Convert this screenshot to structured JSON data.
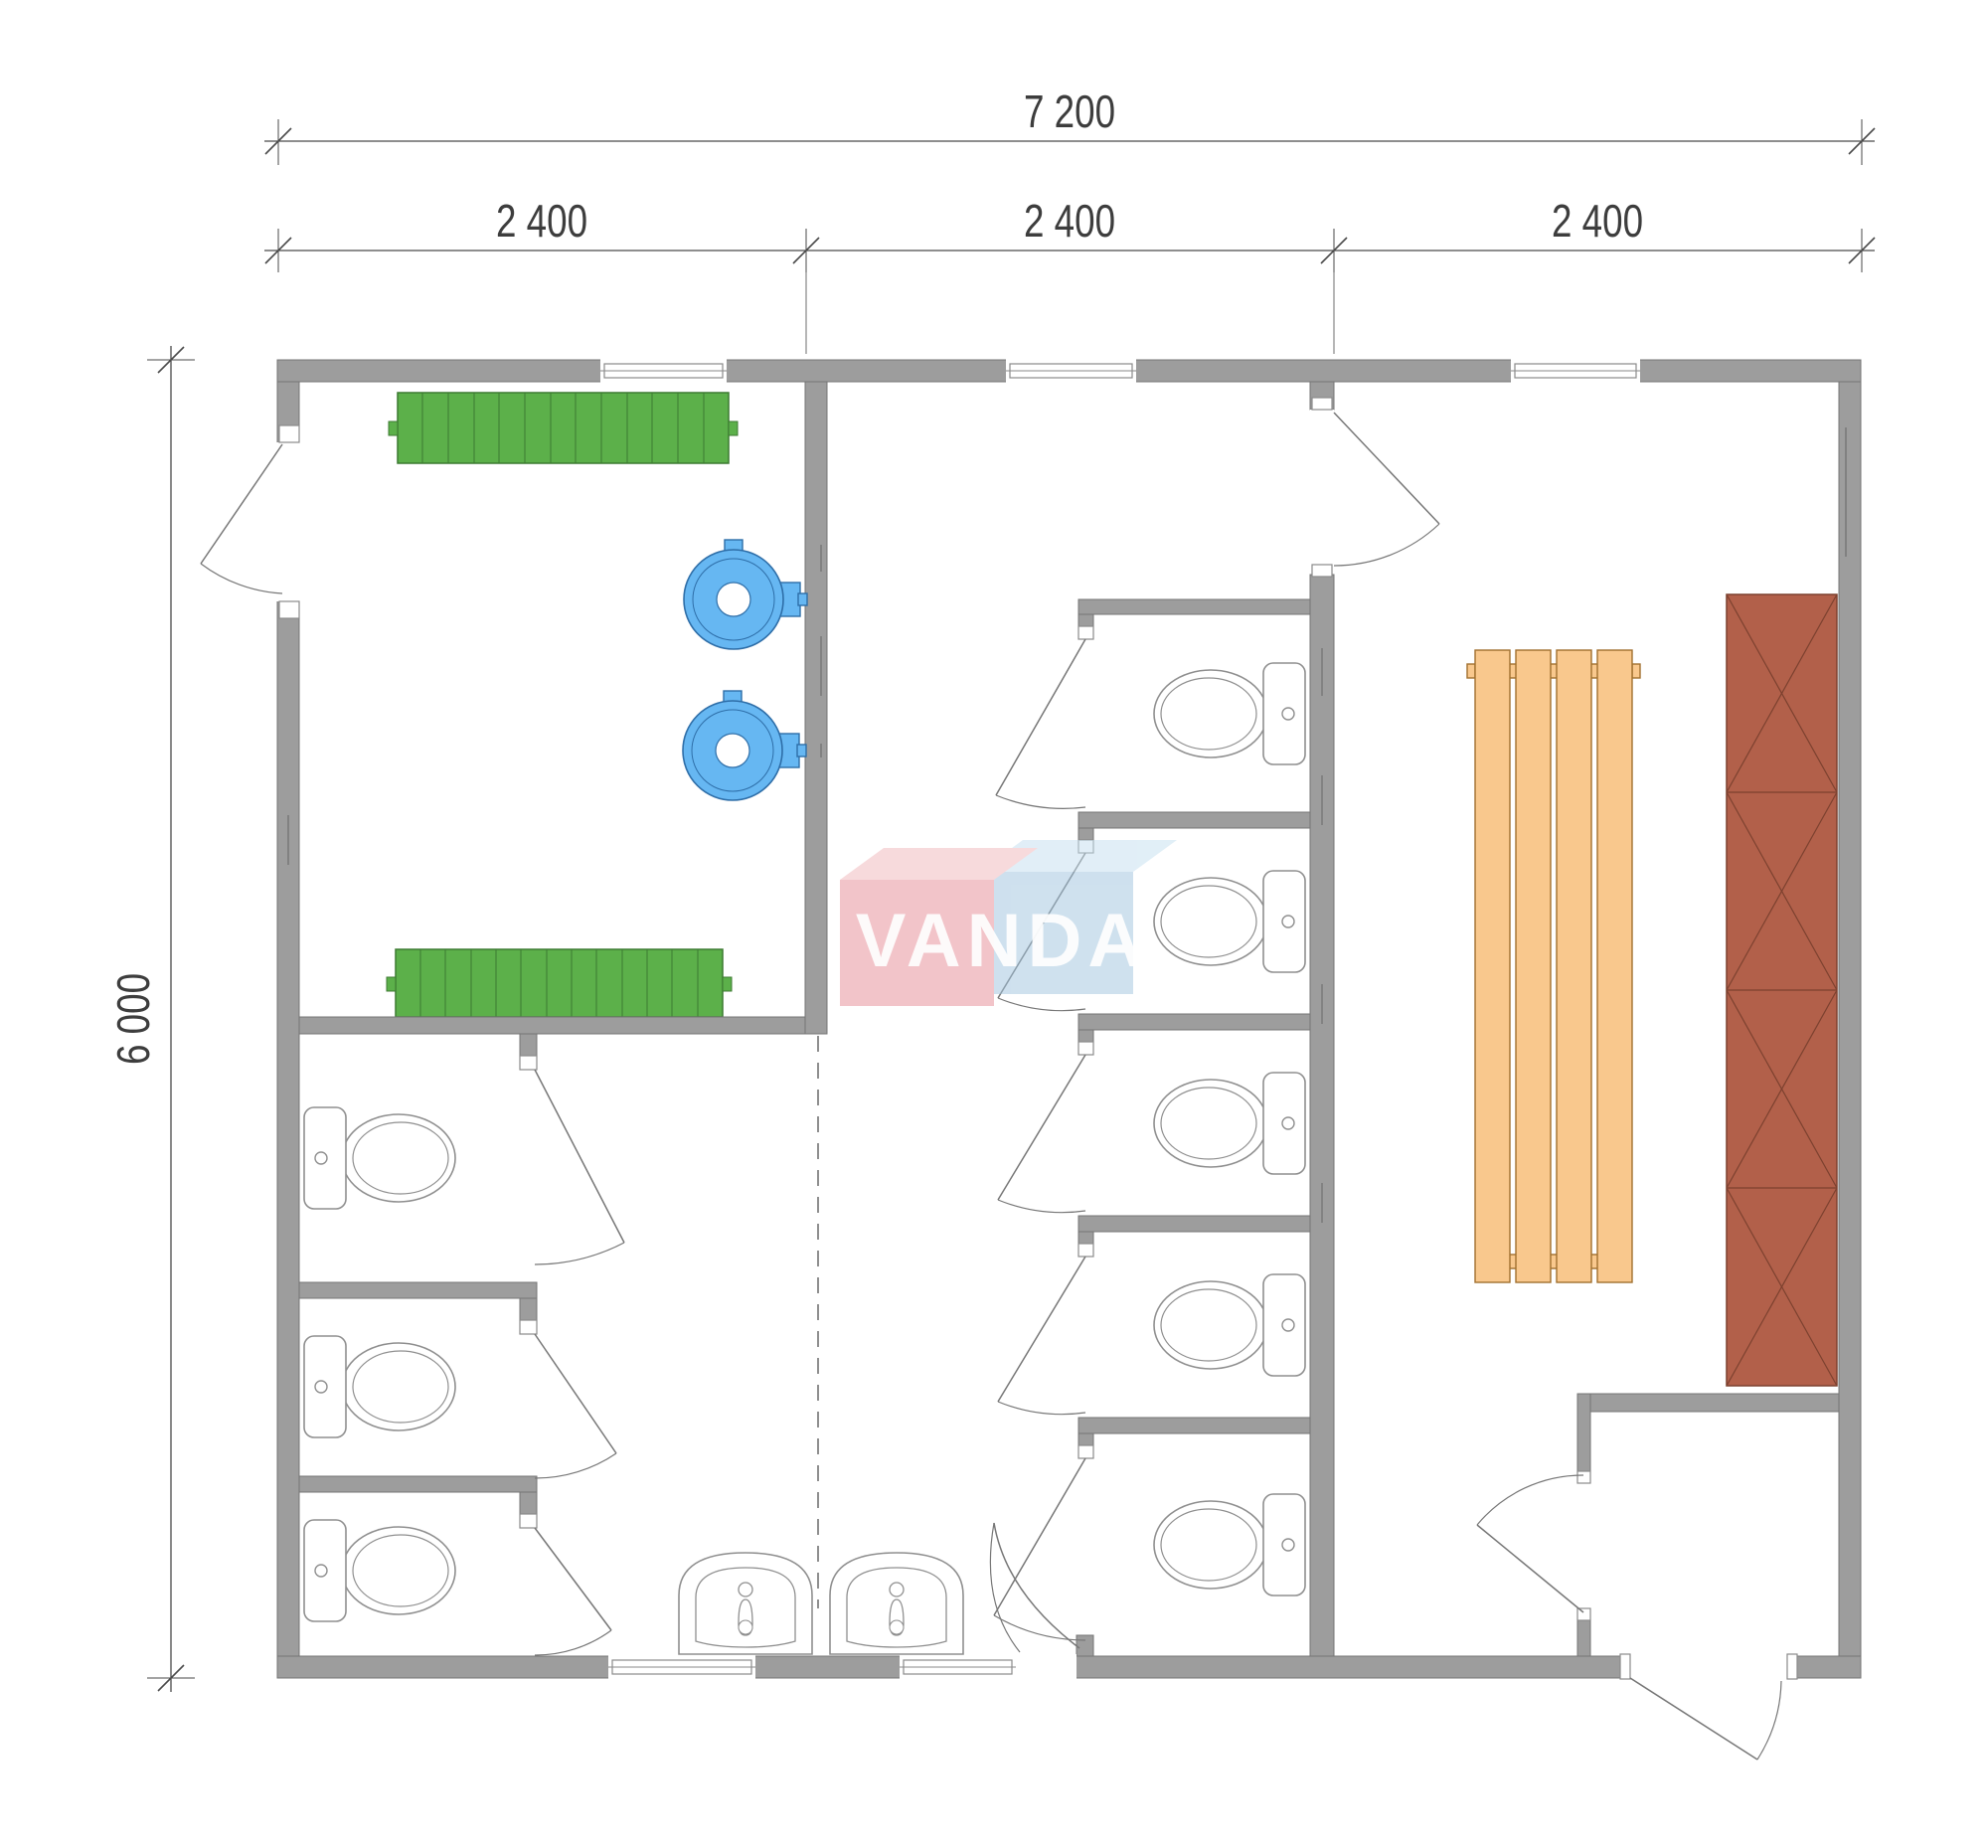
{
  "plan": {
    "title": "sanitary-module-floor-plan",
    "dimensions": {
      "total_width_label": "7 200",
      "module_labels": [
        "2 400",
        "2 400",
        "2 400"
      ],
      "total_height_label": "6 000"
    },
    "watermark": {
      "text": "VANDA",
      "pink": "#e68a94",
      "blue": "#9fc3de"
    },
    "colors": {
      "wall_gray": "#9d9d9d",
      "bench_green": "#5cb04a",
      "heater_blue": "#66b7f2",
      "bench_wood": "#f9c88d",
      "locker_brown": "#b2604a",
      "lineart_gray": "#8f8f8f",
      "dimension_ink": "#3d3d3d"
    },
    "fixtures": {
      "toilets": 8,
      "sinks": 2,
      "water_heaters": 2,
      "green_benches": 2,
      "wood_bench_slats": 4,
      "locker_sections": 4,
      "windows": 5,
      "doors": 13
    }
  }
}
